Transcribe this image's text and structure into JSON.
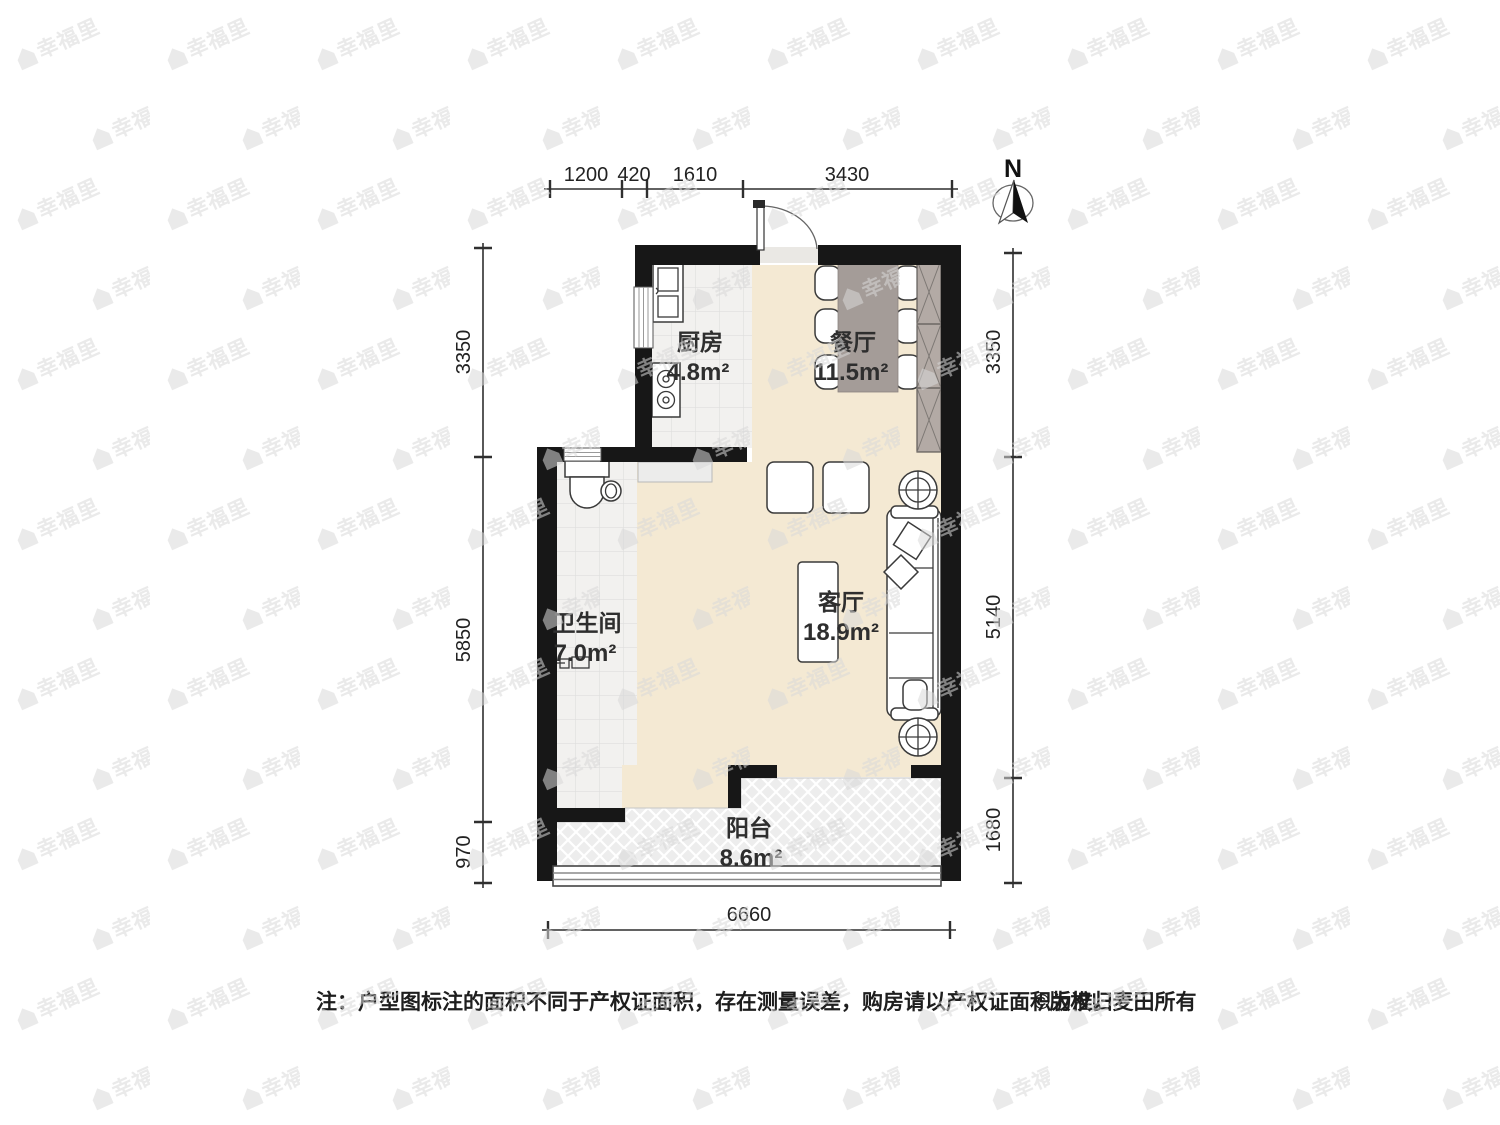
{
  "watermark": {
    "text": "幸福里"
  },
  "compass": {
    "label": "N"
  },
  "rooms": {
    "kitchen": {
      "name": "厨房",
      "area": "4.8m²"
    },
    "dining": {
      "name": "餐厅",
      "area": "11.5m²"
    },
    "living": {
      "name": "客厅",
      "area": "18.9m²"
    },
    "bathroom": {
      "name": "卫生间",
      "area": "7.0m²"
    },
    "balcony": {
      "name": "阳台",
      "area": "8.6m²"
    }
  },
  "dimensions": {
    "top": [
      "1200",
      "420",
      "1610",
      "3430"
    ],
    "left": [
      "3350",
      "5850",
      "970"
    ],
    "right": [
      "3350",
      "5140",
      "1680"
    ],
    "bottom": [
      "6660"
    ]
  },
  "footer": {
    "note": "注：户型图标注的面积不同于产权证面积，存在测量误差，购房请以产权证面积为准。",
    "copyright": "©版权归麦田所有"
  },
  "colors": {
    "wall": "#171717",
    "floor_beige": "#f4e9d3",
    "tile": "#f2f1ef",
    "balcony_bg": "#ededed",
    "table": "#a49c98",
    "wardrobe": "#b3aaa5",
    "label_text": "#2e2e2e"
  }
}
